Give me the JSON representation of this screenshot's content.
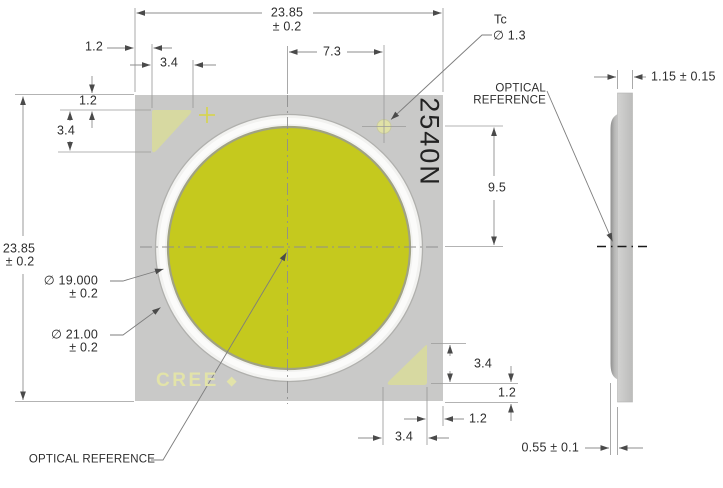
{
  "colors": {
    "die_yellow": "#c5c91e",
    "package_gray": "#c9c9c8",
    "fiducial_pale_yellow": "#d7d9a1",
    "tc_pad_yellow": "#e0e1a6",
    "ring_white": "#f2f2f0",
    "drawing_line_gray": "#909090",
    "text_dark": "#2d2d2d"
  },
  "top_view": {
    "part_marking": "2540N",
    "brand": "CREE",
    "brand_mark": "◆",
    "labels": {
      "optical_reference": "OPTICAL REFERENCE",
      "tc": "Tc",
      "tc_diameter": "∅ 1.3"
    },
    "dimensions": {
      "overall_width": {
        "value": "23.85",
        "tolerance": "± 0.2"
      },
      "overall_height": {
        "value": "23.85",
        "tolerance": "± 0.2"
      },
      "light_emitting_diameter": {
        "value": "∅ 19.000",
        "tolerance": "± 0.2"
      },
      "dam_diameter": {
        "value": "∅ 21.00",
        "tolerance": "± 0.2"
      },
      "tc_offset_from_center": "7.3",
      "tc_to_center_vertical": "9.5",
      "fiducial_inset_top_x": "1.2",
      "fiducial_width_top": "3.4",
      "fiducial_inset_top_y": "1.2",
      "fiducial_height_left": "3.4",
      "fiducial_height_right": "3.4",
      "fiducial_inset_bottom_y": "1.2",
      "fiducial_inset_bottom_x": "1.2",
      "fiducial_width_bottom": "3.4"
    }
  },
  "side_view": {
    "labels": {
      "optical_reference_line1": "OPTICAL",
      "optical_reference_line2": "REFERENCE"
    },
    "dimensions": {
      "total_thickness": "1.15 ± 0.15",
      "lens_height": "0.55 ± 0.1"
    }
  }
}
